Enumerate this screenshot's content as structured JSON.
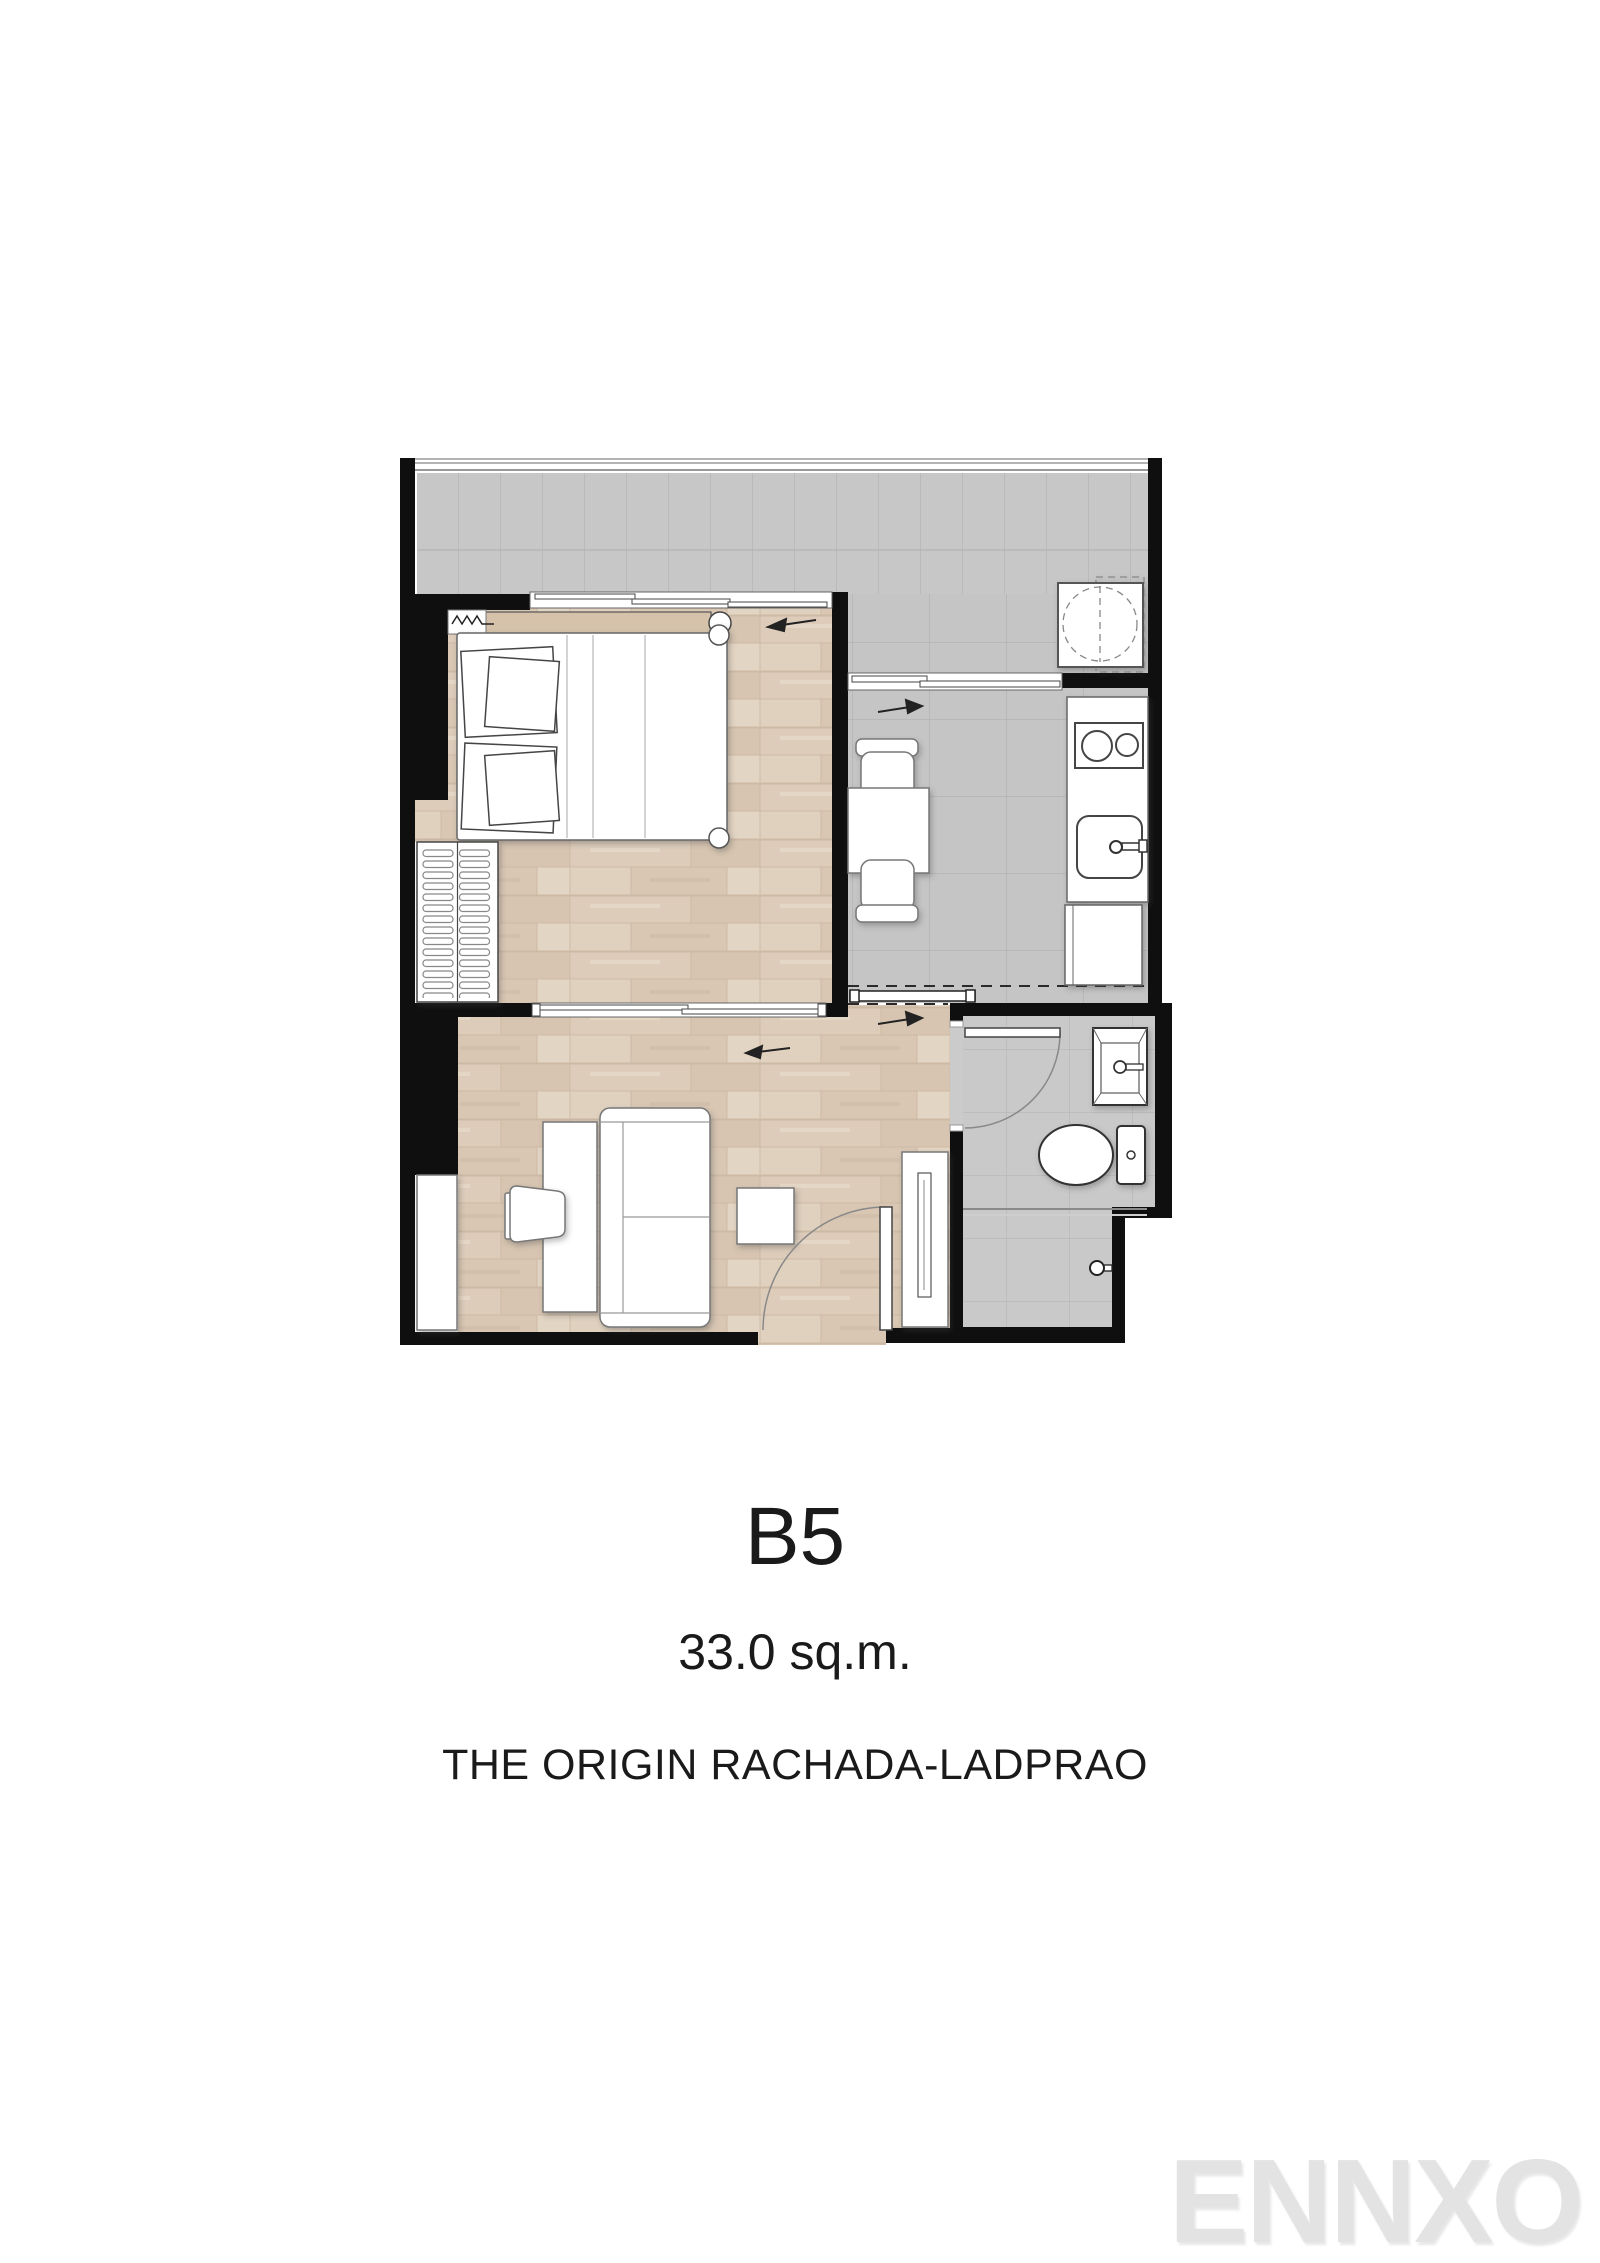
{
  "unit": {
    "code": "B5",
    "area": "33.0 sq.m.",
    "project": "THE ORIGIN RACHADA-LADPRAO"
  },
  "watermark": {
    "text": "ENNXO"
  },
  "colors": {
    "page_bg": "#ffffff",
    "wall": "#0f0f0f",
    "tile": "#c7c7c7",
    "tile_line": "#b5b5b5",
    "wood": "#dbc9b6",
    "wood_dark": "#d2bfa9",
    "wood_light": "#e3d5c3",
    "curtain_beige": "#d6c2ab",
    "furniture_outline": "#555555",
    "text": "#1a1a1a",
    "watermark": "#e3e3e3"
  },
  "floor_plan": {
    "rooms": [
      {
        "name": "balcony",
        "floor": "tile"
      },
      {
        "name": "bedroom",
        "floor": "wood"
      },
      {
        "name": "kitchen-dining",
        "floor": "tile"
      },
      {
        "name": "living-room",
        "floor": "wood"
      },
      {
        "name": "bathroom",
        "floor": "tile"
      }
    ],
    "fixtures": [
      "balcony-railing",
      "washing-machine",
      "bed",
      "pillows",
      "curtain-rail",
      "wardrobe",
      "sliding-window-balcony-bedroom",
      "sliding-window-balcony-kitchen",
      "sliding-window-bedroom-living",
      "dining-table",
      "dining-chair",
      "dining-chair",
      "kitchen-counter",
      "stove",
      "kitchen-sink",
      "kitchen-cabinet",
      "sliding-door-kitchen-living",
      "desk",
      "desk-chair",
      "sofa",
      "side-table",
      "tv-cabinet",
      "storage-cabinet",
      "entrance-door",
      "bathroom-door",
      "wash-basin",
      "toilet",
      "shower",
      "shower-partition",
      "direction-arrows"
    ]
  }
}
